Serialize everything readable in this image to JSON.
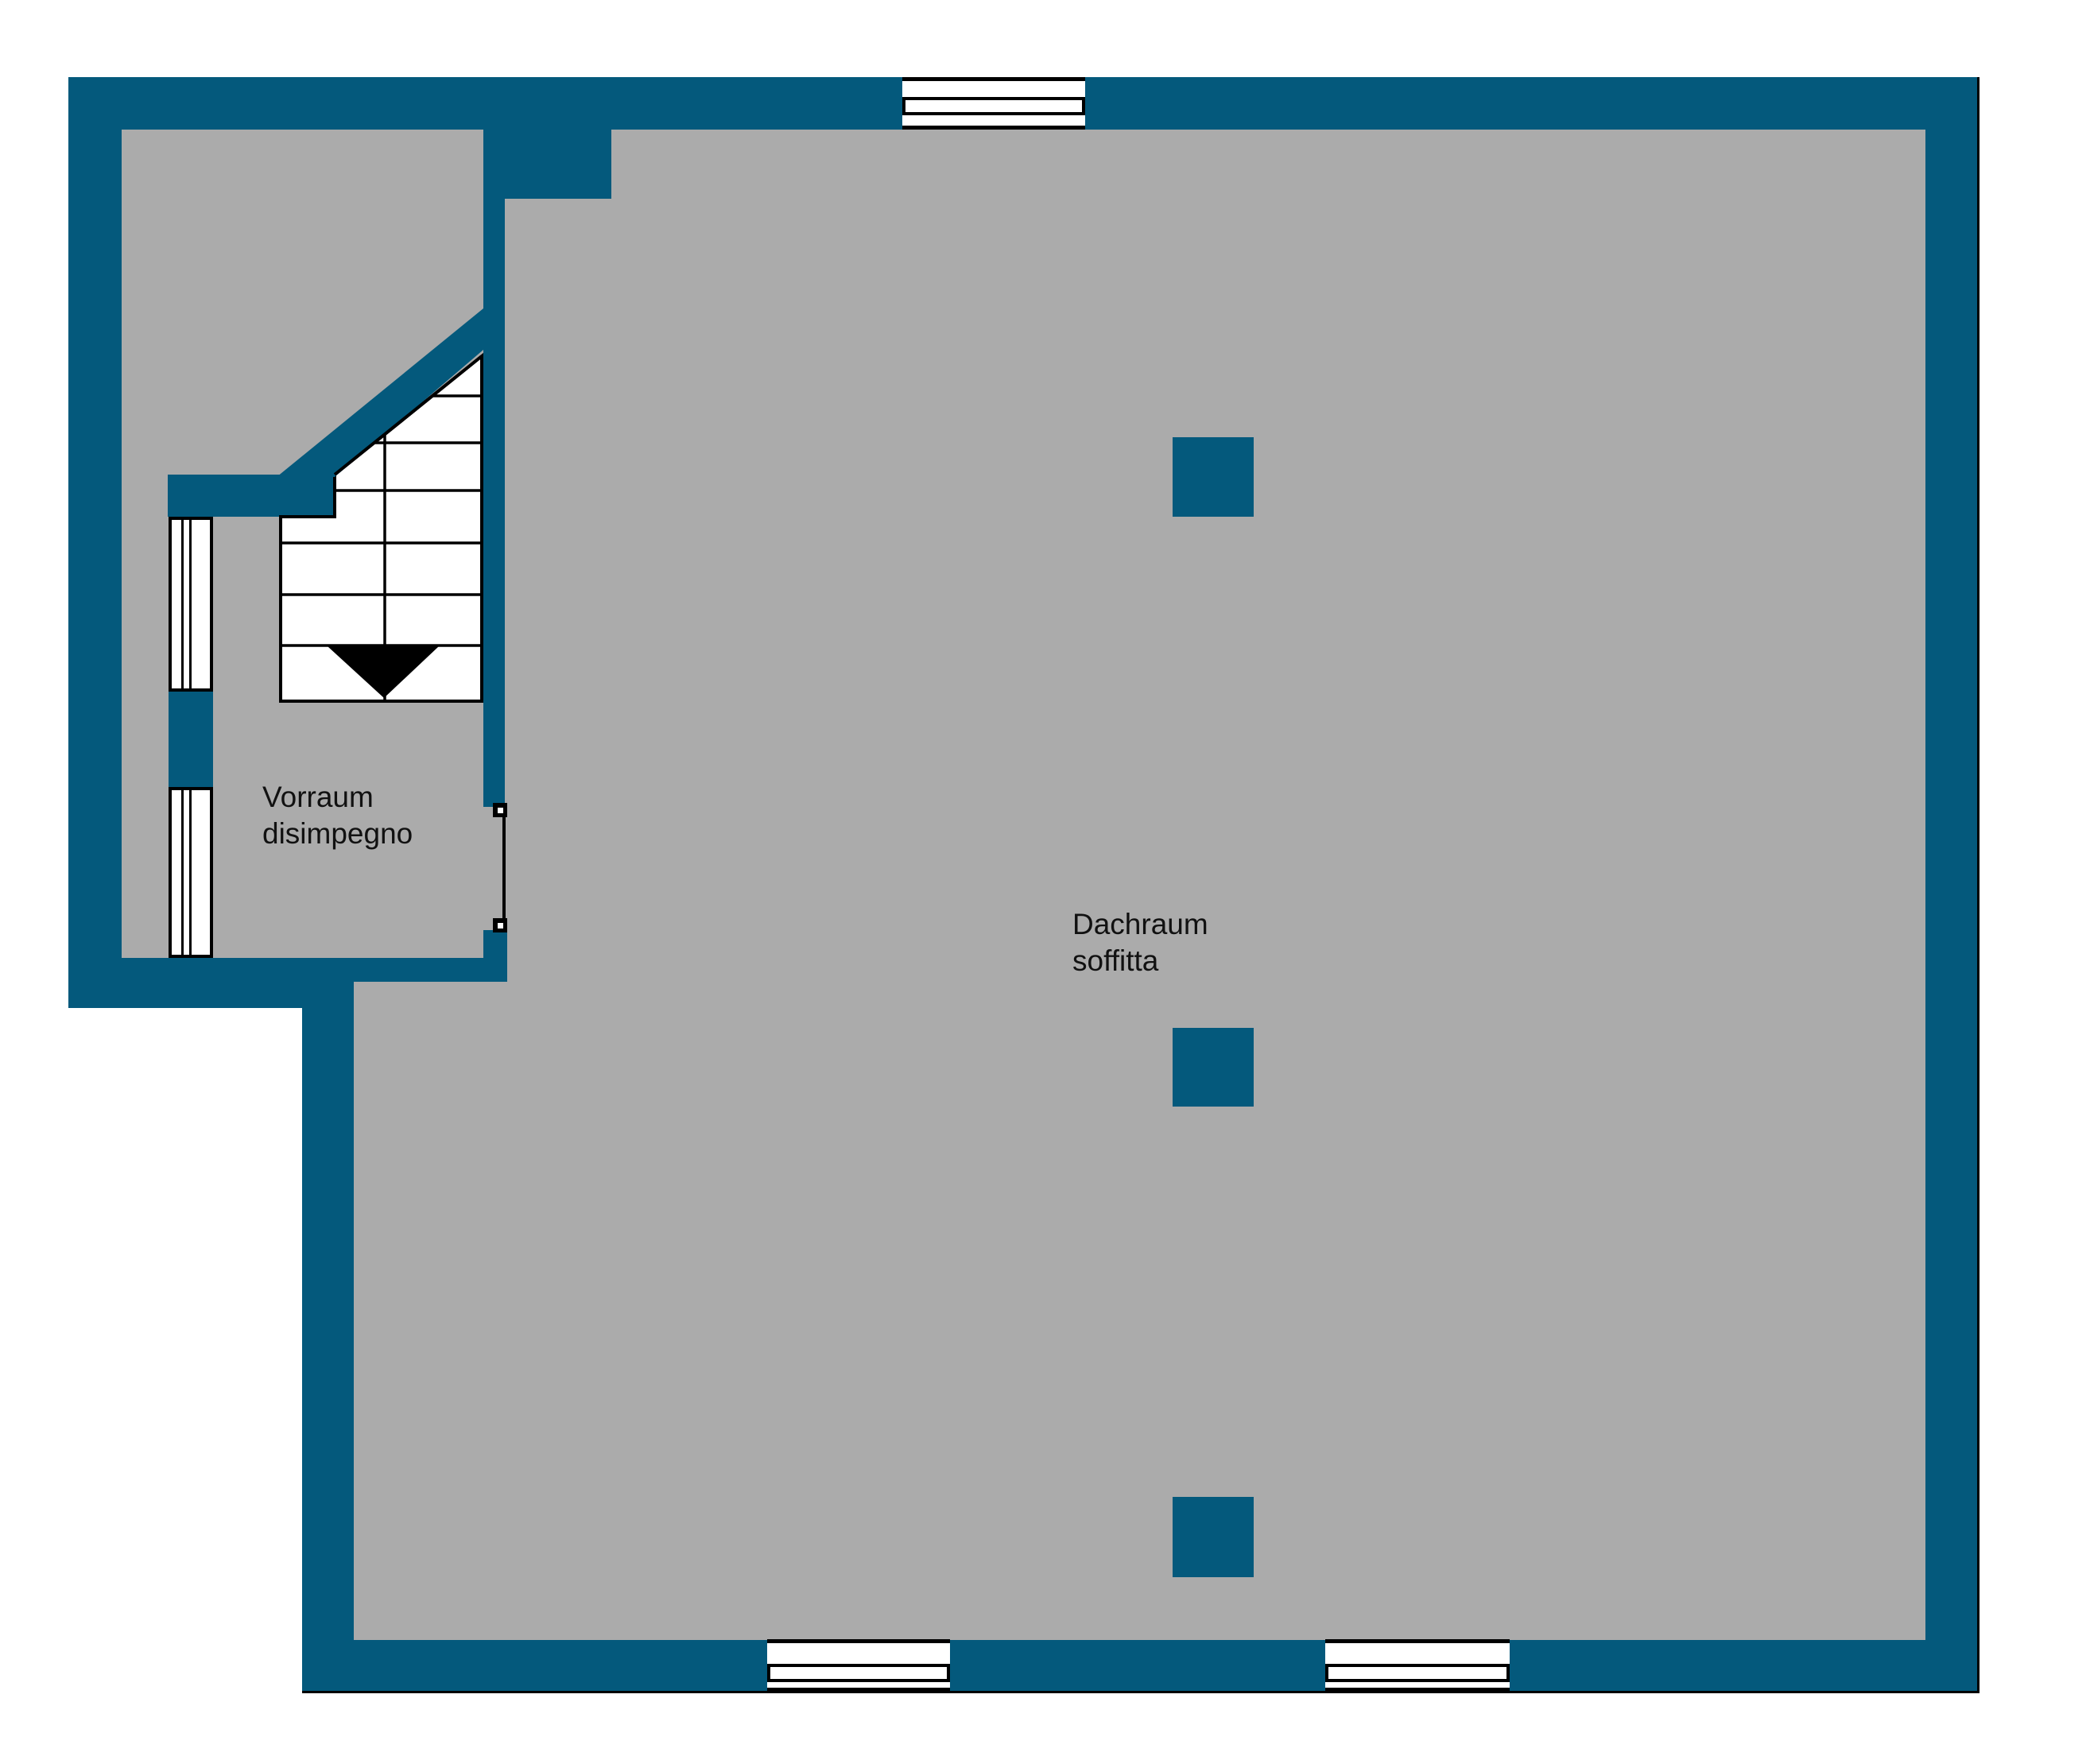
{
  "title": "Attic floor plan",
  "colors": {
    "wall": "#04597C",
    "floor": "#ABABAB",
    "outline": "#000000",
    "bg": "#FFFFFF"
  },
  "rooms": {
    "vorraum": {
      "line1": "Vorraum",
      "line2": "disimpegno"
    },
    "dachraum": {
      "line1": "Dachraum",
      "line2": "soffitta"
    }
  },
  "elements": {
    "windows_count": 3,
    "side_window_strips": 2,
    "pillars_count": 3,
    "stair_direction": "down"
  }
}
